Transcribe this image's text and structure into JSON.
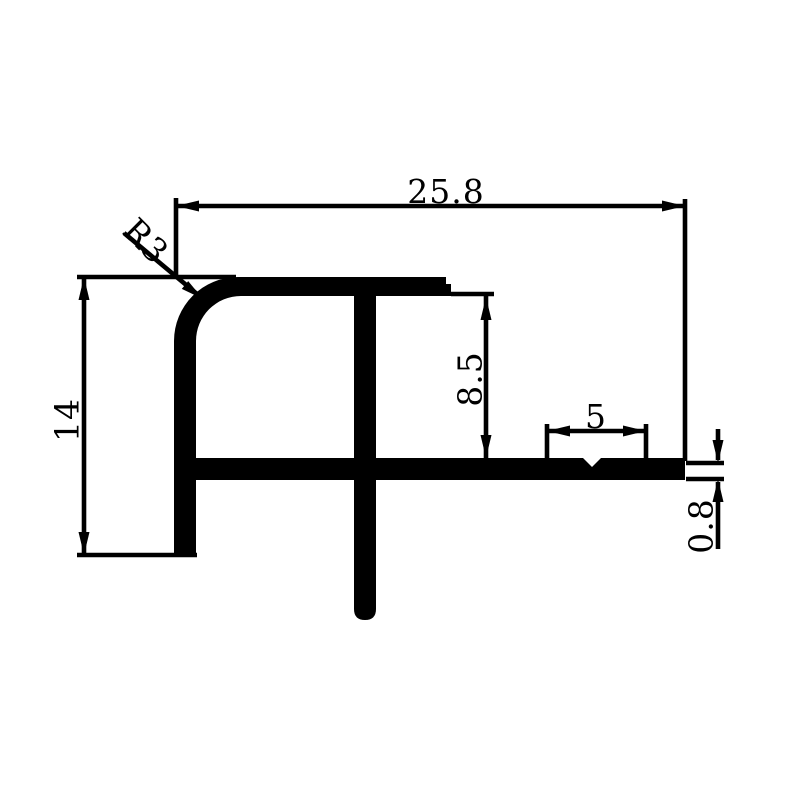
{
  "drawing": {
    "type": "technical-profile-cross-section",
    "labels": {
      "overall_width": "25.8",
      "corner_radius": "R3",
      "overall_height": "14",
      "inner_height": "8.5",
      "notch_zone_width": "5",
      "flange_tip_thickness": "0.8"
    },
    "colors": {
      "ink": "#000000",
      "background": "#ffffff"
    }
  }
}
